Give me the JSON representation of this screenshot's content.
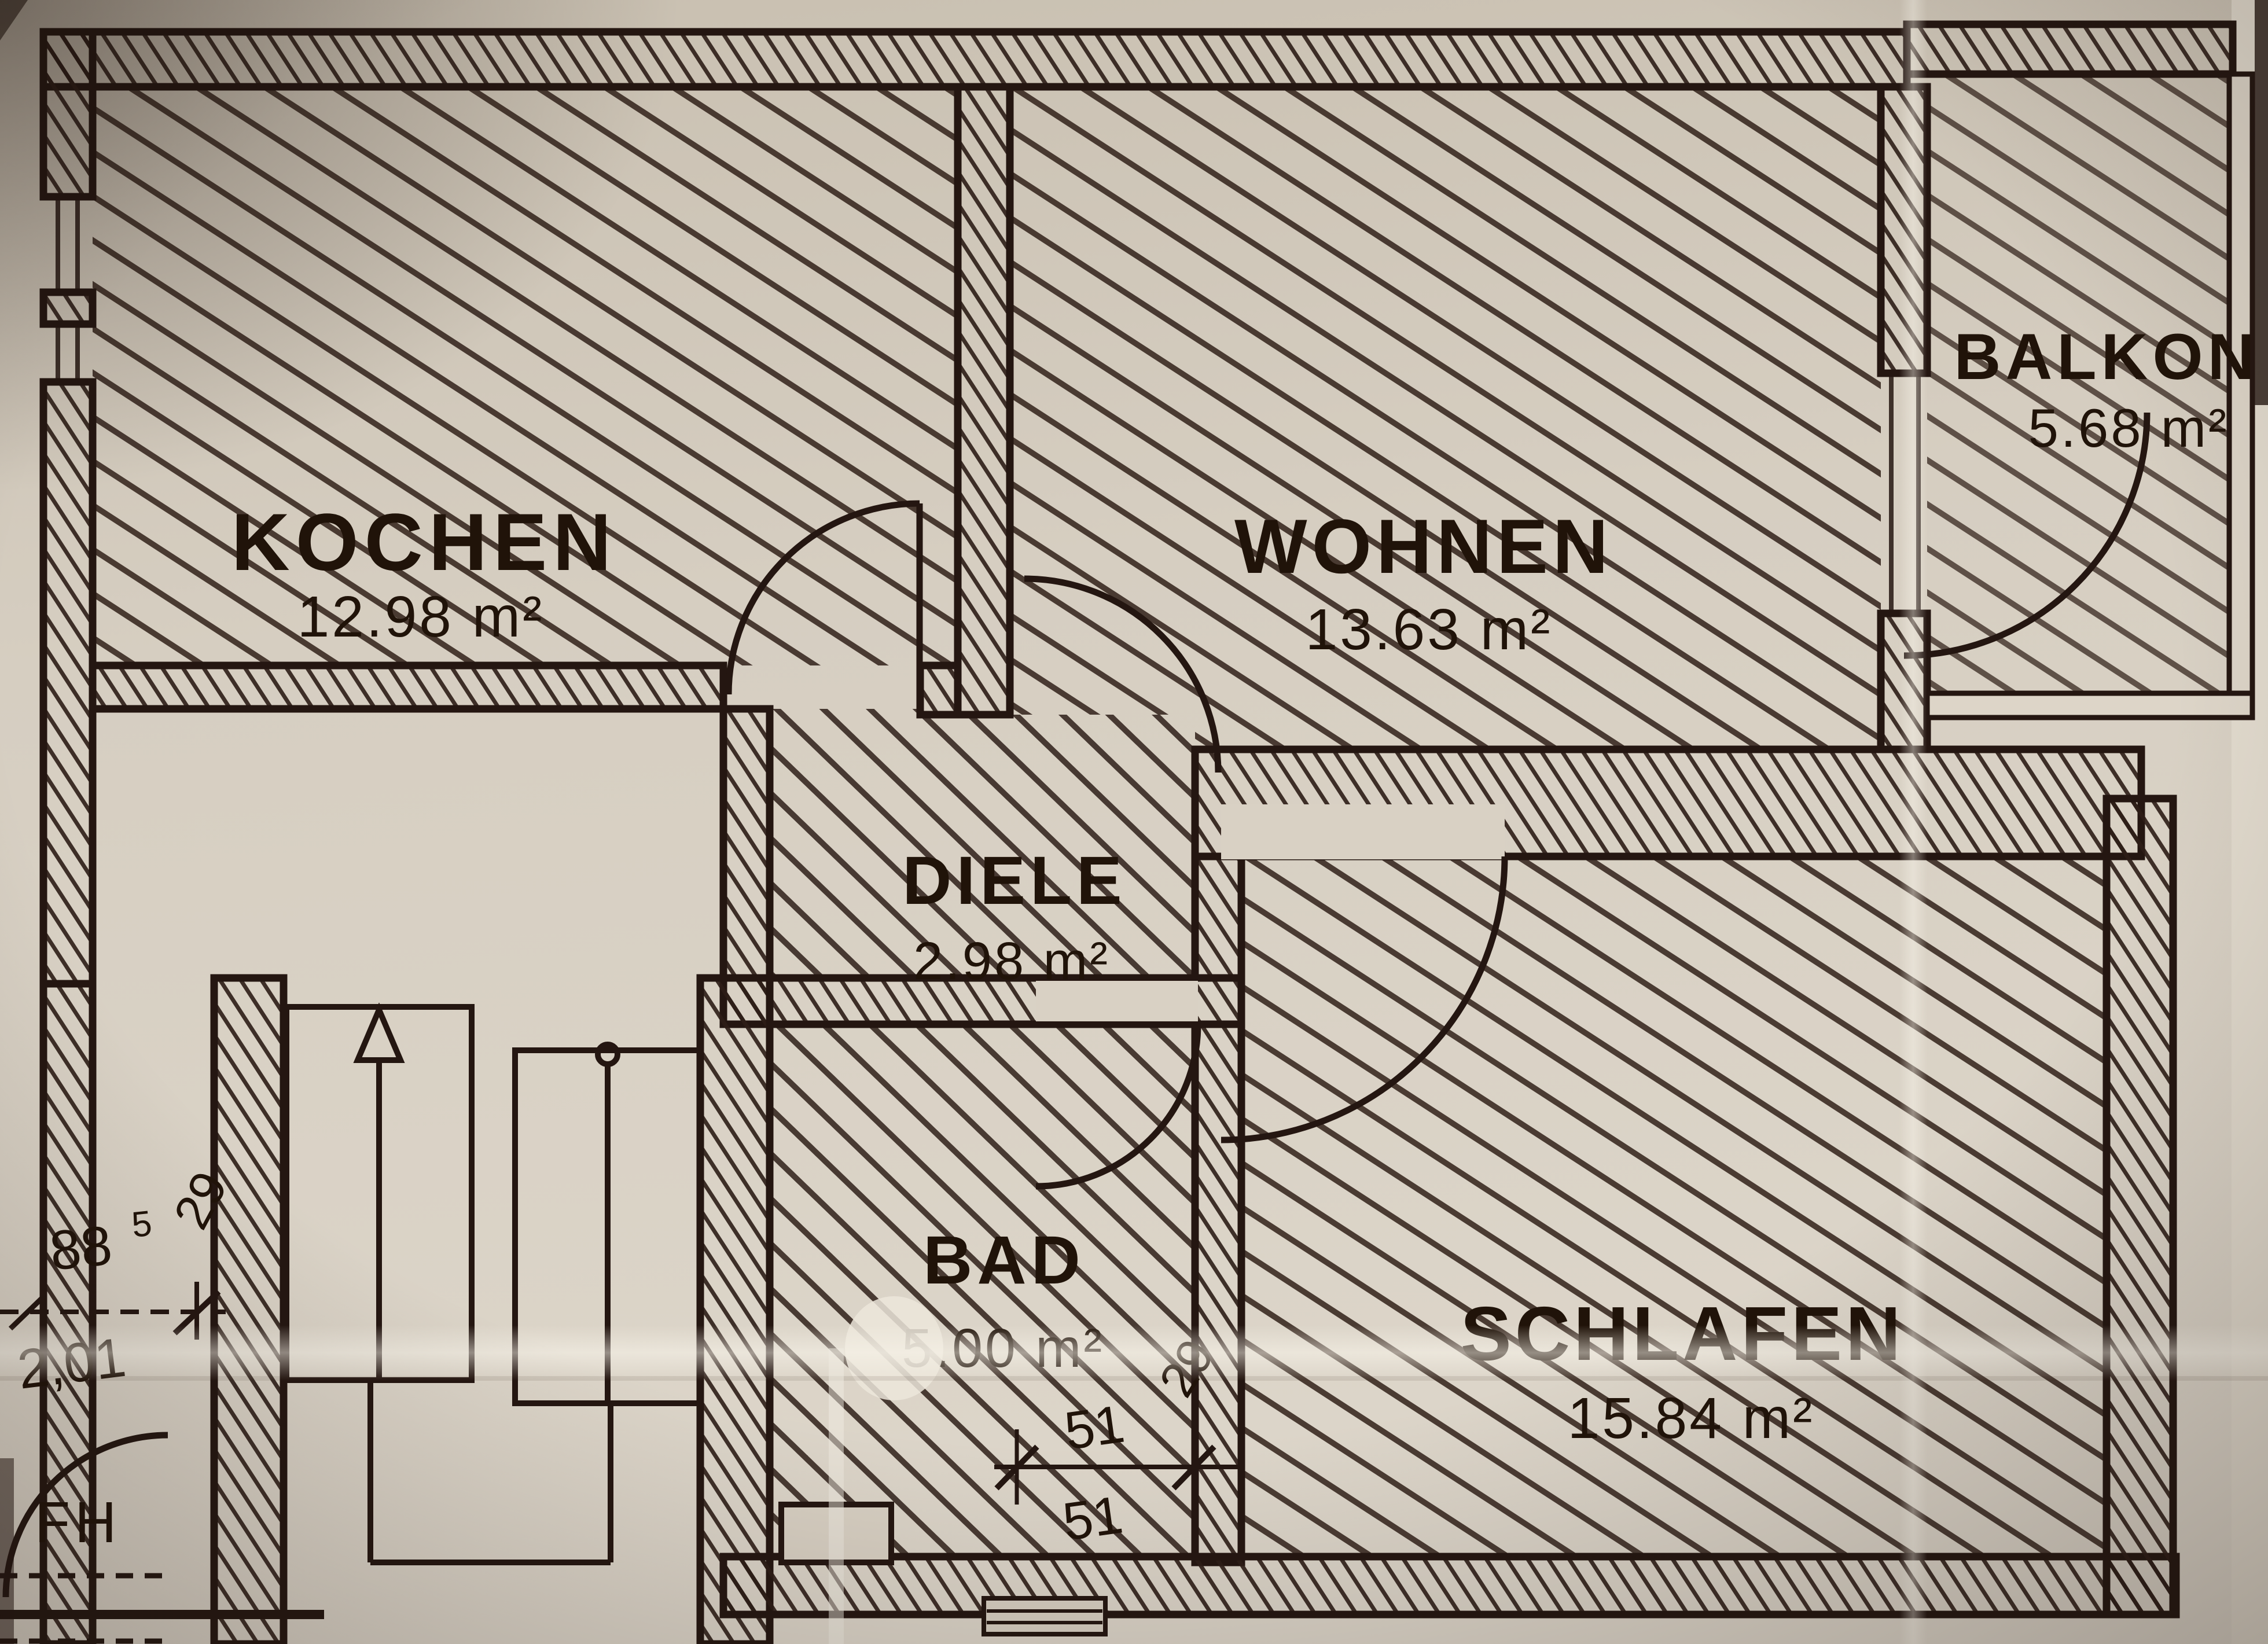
{
  "document": {
    "kind": "architectural floor plan (scanned photo)",
    "language": "de"
  },
  "rooms": [
    {
      "id": "kochen",
      "label": "KOCHEN",
      "area": "12.98 m²"
    },
    {
      "id": "wohnen",
      "label": "WOHNEN",
      "area": "13.63 m²"
    },
    {
      "id": "balkon",
      "label": "BALKON",
      "area": "5.68 m²"
    },
    {
      "id": "diele",
      "label": "DIELE",
      "area": "2.98 m²"
    },
    {
      "id": "bad",
      "label": "BAD",
      "area": "5.00 m²"
    },
    {
      "id": "schlafen",
      "label": "SCHLAFEN",
      "area": "15.84 m²"
    }
  ],
  "annotations": {
    "fh": "FH",
    "dim_left_width": {
      "main": "88",
      "sup": "5"
    },
    "dim_left_height": "2,01",
    "dim_left_wall": "29",
    "dim_bad_top": "51",
    "dim_bad_wall": "29",
    "dim_bad_bottom": "51"
  },
  "colors": {
    "paper": "#d6cec1",
    "ink": "#241611",
    "hatch": "#3a2a22"
  }
}
